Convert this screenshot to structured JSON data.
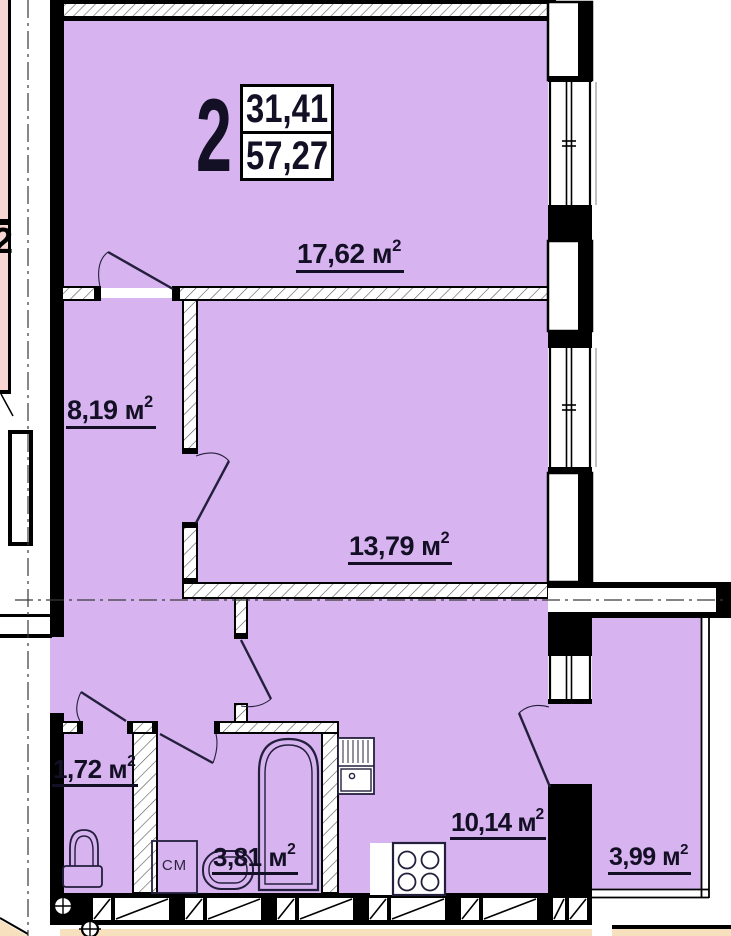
{
  "floor_plan": {
    "apartment": {
      "number": "2",
      "living_area": "31,41",
      "total_area": "57,27"
    },
    "adjacent_apartment_number": "2",
    "area_unit": {
      "letter": "м",
      "sup": "2"
    },
    "rooms": [
      {
        "name": "living-room",
        "area": "17,62"
      },
      {
        "name": "hallway",
        "area": "8,19"
      },
      {
        "name": "bedroom",
        "area": "13,79"
      },
      {
        "name": "wc",
        "area": "1,72"
      },
      {
        "name": "bathroom",
        "area": "3,81"
      },
      {
        "name": "kitchen",
        "area": "10,14"
      },
      {
        "name": "balcony",
        "area": "3,99"
      }
    ],
    "fixtures": {
      "washing_machine": "СМ"
    },
    "colors": {
      "room_fill": "#d7b3ef",
      "adjacent_fill": "#f8d7d3",
      "lower_floor_fill": "#f7e0bd",
      "wall": "#000000",
      "text": "#130f24"
    }
  }
}
